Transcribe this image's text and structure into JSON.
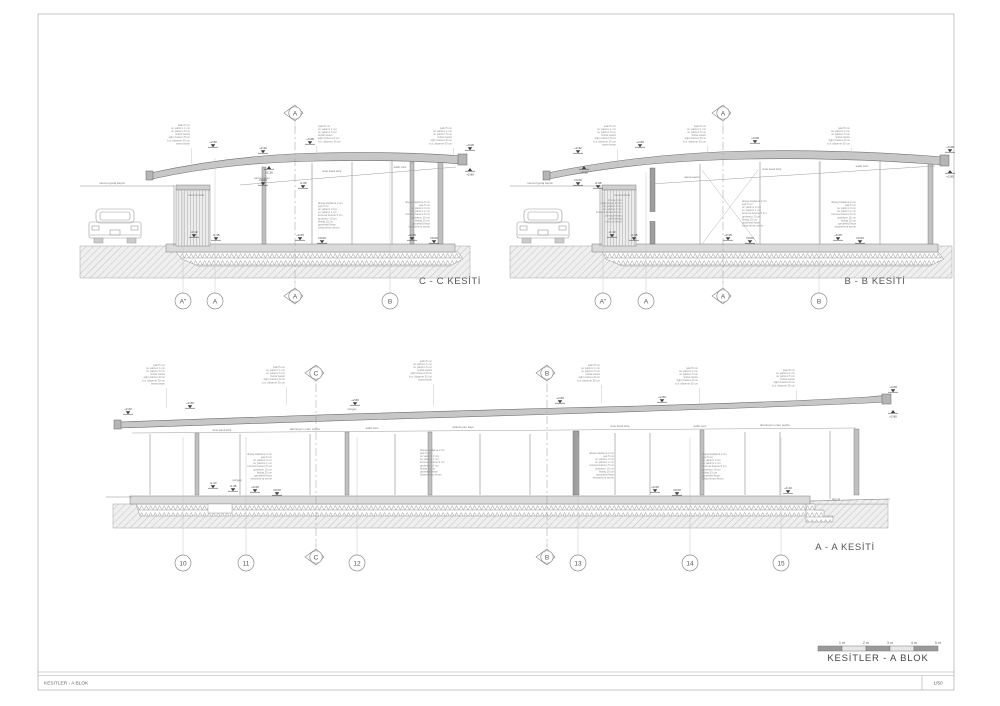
{
  "sheet": {
    "title_block": "KESITLER - A BLOK",
    "scale": "1/50"
  },
  "legend": {
    "title": "KESİTLER  - A BLOK",
    "scale_labels": [
      "1 m",
      "2 m",
      "3 m",
      "4 m",
      "5 m"
    ]
  },
  "sections": {
    "cc": {
      "title": "C - C KESİTİ"
    },
    "bb": {
      "title": "B - B KESİTİ"
    },
    "aa": {
      "title": "A - A KESİTİ"
    }
  },
  "stacks": {
    "roof": [
      "çakıl 5 cm",
      "su yalıtımı 1 cm",
      "ısı yalıtımı 5 cm",
      "buhar kesici",
      "eğim betonu 8 cm",
      "b.a. döşeme 30 cm",
      "asma tavan"
    ],
    "floor": [
      "ahşap kaplama 2 cm",
      "şap 5 cm",
      "ısı yalıtımı 3 cm",
      "su yalıtımı 1 cm",
      "koruma betonu 5 cm",
      "grobeton 10 cm",
      "blokaj 15 cm",
      "geotekstil keçe",
      "sıkıştırılmış zemin"
    ],
    "wall": [
      "iç sıva 2 cm",
      "tuğla duvar 19 cm",
      "ısı yalıtımı 5 cm",
      "su yalıtımı 1 cm",
      "koruma duvarı 8.5 cm",
      "drenaj levhası",
      "çakıl drenaj",
      "mevcut zemin"
    ]
  },
  "note_blocks": [
    {
      "x": 190,
      "y": 126,
      "align": "right",
      "stack": "roof",
      "n": 7,
      "leader": 16
    },
    {
      "x": 318,
      "y": 127,
      "align": "left",
      "stack": "roof",
      "n": 6,
      "leader": 14
    },
    {
      "x": 452,
      "y": 129,
      "align": "right",
      "stack": "roof",
      "n": 6,
      "leader": 12
    },
    {
      "x": 318,
      "y": 204,
      "align": "left",
      "stack": "floor",
      "n": 9,
      "leader": 0
    },
    {
      "x": 430,
      "y": 203,
      "align": "right",
      "stack": "floor",
      "n": 9,
      "leader": 0
    },
    {
      "x": 616,
      "y": 127,
      "align": "right",
      "stack": "roof",
      "n": 7,
      "leader": 16
    },
    {
      "x": 706,
      "y": 127,
      "align": "right",
      "stack": "roof",
      "n": 6,
      "leader": 14
    },
    {
      "x": 850,
      "y": 129,
      "align": "right",
      "stack": "roof",
      "n": 6,
      "leader": 12
    },
    {
      "x": 742,
      "y": 202,
      "align": "left",
      "stack": "floor",
      "n": 9,
      "leader": 0
    },
    {
      "x": 856,
      "y": 203,
      "align": "right",
      "stack": "floor",
      "n": 9,
      "leader": 0
    },
    {
      "x": 622,
      "y": 201,
      "align": "right",
      "stack": "wall",
      "n": 8,
      "leader": 0
    },
    {
      "x": 165,
      "y": 366,
      "align": "right",
      "stack": "roof",
      "n": 7,
      "leader": 20
    },
    {
      "x": 285,
      "y": 368,
      "align": "right",
      "stack": "roof",
      "n": 6,
      "leader": 18
    },
    {
      "x": 432,
      "y": 362,
      "align": "right",
      "stack": "roof",
      "n": 7,
      "leader": 22
    },
    {
      "x": 600,
      "y": 366,
      "align": "right",
      "stack": "roof",
      "n": 6,
      "leader": 18
    },
    {
      "x": 698,
      "y": 369,
      "align": "right",
      "stack": "roof",
      "n": 6,
      "leader": 16
    },
    {
      "x": 795,
      "y": 371,
      "align": "right",
      "stack": "roof",
      "n": 6,
      "leader": 14
    },
    {
      "x": 272,
      "y": 455,
      "align": "right",
      "stack": "floor",
      "n": 9,
      "leader": 0
    },
    {
      "x": 420,
      "y": 451,
      "align": "left",
      "stack": "floor",
      "n": 9,
      "leader": 0
    },
    {
      "x": 614,
      "y": 454,
      "align": "right",
      "stack": "floor",
      "n": 9,
      "leader": 0
    },
    {
      "x": 702,
      "y": 455,
      "align": "left",
      "stack": "floor",
      "n": 9,
      "leader": 0
    }
  ],
  "small_labels": [
    {
      "x": 112,
      "y": 184,
      "text": "mevcut garaj kapısı"
    },
    {
      "x": 196,
      "y": 196,
      "text": "mevcut bina"
    },
    {
      "x": 262,
      "y": 179,
      "text": "asma tavan"
    },
    {
      "x": 332,
      "y": 172,
      "text": "kutu kesit kiriş"
    },
    {
      "x": 400,
      "y": 168,
      "text": "sabit cam"
    },
    {
      "x": 540,
      "y": 184,
      "text": "mevcut garaj kapısı"
    },
    {
      "x": 622,
      "y": 196,
      "text": "mevcut bina"
    },
    {
      "x": 692,
      "y": 178,
      "text": "asma tavan"
    },
    {
      "x": 772,
      "y": 170,
      "text": "kutu kesit kiriş"
    },
    {
      "x": 862,
      "y": 167,
      "text": "sabit cam"
    },
    {
      "x": 222,
      "y": 431,
      "text": "kutu kesit kiriş"
    },
    {
      "x": 305,
      "y": 430,
      "text": "alüminyum cam cephe"
    },
    {
      "x": 372,
      "y": 429,
      "text": "sabit cam"
    },
    {
      "x": 463,
      "y": 428,
      "text": "alüminyum kapı"
    },
    {
      "x": 620,
      "y": 427,
      "text": "kutu kesit kiriş"
    },
    {
      "x": 700,
      "y": 427,
      "text": "sabit cam"
    },
    {
      "x": 775,
      "y": 426,
      "text": "alüminyum cam cephe"
    },
    {
      "x": 352,
      "y": 410,
      "text": "süzgeç"
    },
    {
      "x": 237,
      "y": 481,
      "text": "süzgeç"
    },
    {
      "x": 836,
      "y": 500,
      "text": "drenaj"
    }
  ],
  "elevations": [
    {
      "x": 213,
      "y": 143,
      "label": "+2.80",
      "dir": "down"
    },
    {
      "x": 310,
      "y": 140,
      "label": "+3.08",
      "dir": "down"
    },
    {
      "x": 470,
      "y": 146,
      "label": "+3.08",
      "dir": "down"
    },
    {
      "x": 470,
      "y": 168,
      "label": "+2.80",
      "dir": "up"
    },
    {
      "x": 263,
      "y": 149,
      "label": "+2.62",
      "dir": "down"
    },
    {
      "x": 269,
      "y": 166,
      "label": "+2.30",
      "dir": "up"
    },
    {
      "x": 263,
      "y": 181,
      "label": "±0.00",
      "dir": "down"
    },
    {
      "x": 303,
      "y": 184,
      "label": "-0.08",
      "dir": "down"
    },
    {
      "x": 300,
      "y": 236,
      "label": "+0.05",
      "dir": "down"
    },
    {
      "x": 322,
      "y": 239,
      "label": "±0.00",
      "dir": "down"
    },
    {
      "x": 412,
      "y": 236,
      "label": "+0.05",
      "dir": "down"
    },
    {
      "x": 434,
      "y": 239,
      "label": "±0.00",
      "dir": "down"
    },
    {
      "x": 194,
      "y": 233,
      "label": "-0.10",
      "dir": "down"
    },
    {
      "x": 216,
      "y": 236,
      "label": "-0.35",
      "dir": "down"
    },
    {
      "x": 640,
      "y": 143,
      "label": "+2.80",
      "dir": "down"
    },
    {
      "x": 755,
      "y": 139,
      "label": "+3.08",
      "dir": "down"
    },
    {
      "x": 950,
      "y": 148,
      "label": "+3.08",
      "dir": "down"
    },
    {
      "x": 950,
      "y": 170,
      "label": "+2.80",
      "dir": "up"
    },
    {
      "x": 578,
      "y": 149,
      "label": "+2.62",
      "dir": "down"
    },
    {
      "x": 584,
      "y": 166,
      "label": "+2.30",
      "dir": "up"
    },
    {
      "x": 578,
      "y": 181,
      "label": "±0.00",
      "dir": "down"
    },
    {
      "x": 598,
      "y": 184,
      "label": "-0.08",
      "dir": "down"
    },
    {
      "x": 728,
      "y": 236,
      "label": "+0.05",
      "dir": "down"
    },
    {
      "x": 750,
      "y": 239,
      "label": "±0.00",
      "dir": "down"
    },
    {
      "x": 838,
      "y": 236,
      "label": "+0.05",
      "dir": "down"
    },
    {
      "x": 860,
      "y": 239,
      "label": "±0.00",
      "dir": "down"
    },
    {
      "x": 612,
      "y": 233,
      "label": "-0.10",
      "dir": "down"
    },
    {
      "x": 634,
      "y": 236,
      "label": "-0.35",
      "dir": "down"
    },
    {
      "x": 128,
      "y": 410,
      "label": "+2.62",
      "dir": "down"
    },
    {
      "x": 190,
      "y": 404,
      "label": "+2.80",
      "dir": "down"
    },
    {
      "x": 355,
      "y": 401,
      "label": "+2.80",
      "dir": "down"
    },
    {
      "x": 560,
      "y": 399,
      "label": "+2.80",
      "dir": "down"
    },
    {
      "x": 662,
      "y": 398,
      "label": "+2.80",
      "dir": "down"
    },
    {
      "x": 893,
      "y": 388,
      "label": "+3.08",
      "dir": "down"
    },
    {
      "x": 893,
      "y": 410,
      "label": "+2.80",
      "dir": "up"
    },
    {
      "x": 255,
      "y": 488,
      "label": "+0.05",
      "dir": "down"
    },
    {
      "x": 277,
      "y": 491,
      "label": "±0.00",
      "dir": "down"
    },
    {
      "x": 655,
      "y": 488,
      "label": "+0.05",
      "dir": "down"
    },
    {
      "x": 677,
      "y": 491,
      "label": "±0.00",
      "dir": "down"
    },
    {
      "x": 213,
      "y": 484,
      "label": "-0.10",
      "dir": "down"
    },
    {
      "x": 233,
      "y": 487,
      "label": "-0.35",
      "dir": "down"
    },
    {
      "x": 788,
      "y": 489,
      "label": "+0.10",
      "dir": "down"
    }
  ],
  "markers": {
    "circles": [
      {
        "x": 183,
        "y": 301,
        "label": "A\"",
        "stem": 14
      },
      {
        "x": 215,
        "y": 301,
        "label": "A",
        "stem": 14
      },
      {
        "x": 390,
        "y": 301,
        "label": "B",
        "stem": 14
      },
      {
        "x": 603,
        "y": 301,
        "label": "A\"",
        "stem": 14
      },
      {
        "x": 646,
        "y": 301,
        "label": "A",
        "stem": 14
      },
      {
        "x": 819,
        "y": 301,
        "label": "B",
        "stem": 14
      },
      {
        "x": 183,
        "y": 563,
        "label": "10",
        "stem": 14
      },
      {
        "x": 246,
        "y": 563,
        "label": "11",
        "stem": 14
      },
      {
        "x": 357,
        "y": 563,
        "label": "12",
        "stem": 14
      },
      {
        "x": 578,
        "y": 563,
        "label": "13",
        "stem": 14
      },
      {
        "x": 690,
        "y": 563,
        "label": "14",
        "stem": 14
      },
      {
        "x": 781,
        "y": 563,
        "label": "15",
        "stem": 14
      }
    ],
    "diamonds": [
      {
        "x": 295,
        "y": 113,
        "label": "A",
        "tick": "down"
      },
      {
        "x": 295,
        "y": 296,
        "label": "A",
        "tick": "up"
      },
      {
        "x": 723,
        "y": 113,
        "label": "A",
        "tick": "down"
      },
      {
        "x": 723,
        "y": 296,
        "label": "A",
        "tick": "up"
      },
      {
        "x": 316,
        "y": 373,
        "label": "C",
        "tick": "down"
      },
      {
        "x": 547,
        "y": 373,
        "label": "B",
        "tick": "down"
      },
      {
        "x": 316,
        "y": 557,
        "label": "C",
        "tick": "up"
      },
      {
        "x": 547,
        "y": 557,
        "label": "B",
        "tick": "up"
      }
    ]
  },
  "grid_lines": {
    "solid": [
      {
        "x": 183,
        "y1": 192,
        "y2": 279
      },
      {
        "x": 215,
        "y1": 158,
        "y2": 279
      },
      {
        "x": 390,
        "y1": 162,
        "y2": 279
      },
      {
        "x": 603,
        "y1": 192,
        "y2": 279
      },
      {
        "x": 646,
        "y1": 172,
        "y2": 279
      },
      {
        "x": 819,
        "y1": 162,
        "y2": 279
      },
      {
        "x": 183,
        "y1": 437,
        "y2": 541
      },
      {
        "x": 246,
        "y1": 437,
        "y2": 541
      },
      {
        "x": 357,
        "y1": 437,
        "y2": 541
      },
      {
        "x": 578,
        "y1": 437,
        "y2": 541
      },
      {
        "x": 690,
        "y1": 437,
        "y2": 541
      },
      {
        "x": 781,
        "y1": 437,
        "y2": 541
      }
    ],
    "dashed": [
      {
        "x": 295,
        "y1": 126,
        "y2": 286
      },
      {
        "x": 723,
        "y1": 126,
        "y2": 286
      },
      {
        "x": 316,
        "y1": 384,
        "y2": 547
      },
      {
        "x": 547,
        "y1": 384,
        "y2": 547
      }
    ]
  },
  "scalebar": {
    "x": 818,
    "y": 646,
    "seg_w": 24,
    "seg_h": 5,
    "dark": "#9a9a9a",
    "light": "#e8e8e8"
  }
}
